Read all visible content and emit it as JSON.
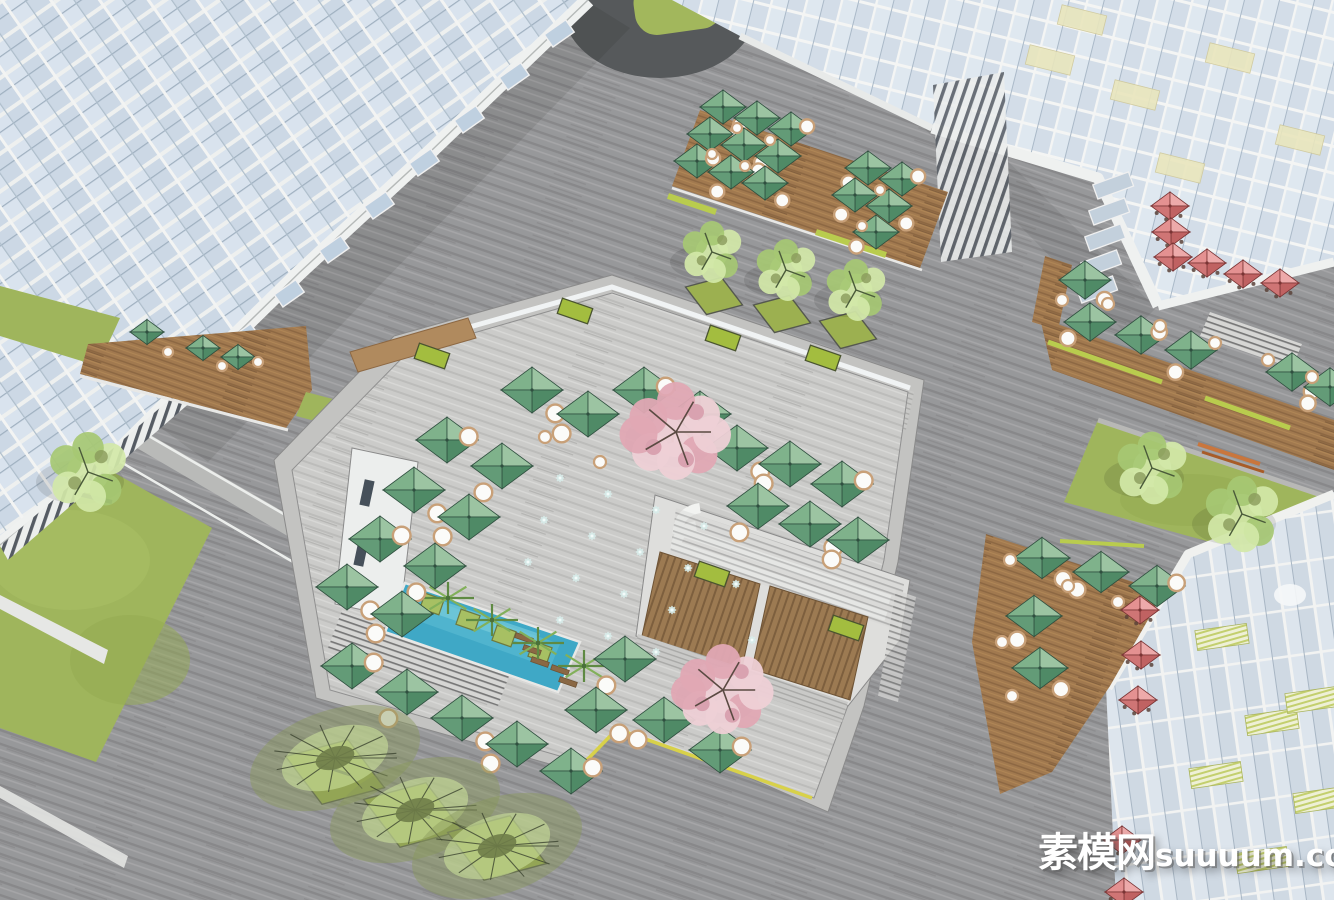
{
  "watermark": {
    "cjk": "素模网",
    "latin": "suuuum.com"
  },
  "colors": {
    "plaza_base": "#97989a",
    "plaza_dark": "#88888a",
    "plaza_light": "#a6a6a8",
    "terrace_base": "#cbcbc9",
    "terrace_dark": "#bdbdbb",
    "terrace_light": "#d8d8d6",
    "umbrella_green_light": "#9cc4a2",
    "umbrella_green_midlight": "#7fb28b",
    "umbrella_green_middark": "#639b77",
    "umbrella_green_dark": "#4f8a66",
    "umbrella_green_edge": "#2f4f3f",
    "umbrella_red_light": "#edaaaa",
    "umbrella_red_midlight": "#e49191",
    "umbrella_red_middark": "#cf7575",
    "umbrella_red_dark": "#c06262",
    "umbrella_red_edge": "#7a3434",
    "table_white": "#fbfbf9",
    "table_ring": "#c8a078",
    "wood_deck": "#a1794f",
    "wood_dark": "#8d6843",
    "grass": "#9fb55c",
    "planter_grass": "#9cb050",
    "lime_box": "#a3bd3f",
    "pool_water": "#3fa8c6",
    "pool_ripple": "#7fd0de",
    "cherry_pink": "#eed0d6",
    "cherry_deep": "#e0a8b4",
    "tree_lime_light": "#d2e8a8",
    "tree_lime_mid": "#a6c873",
    "tree_olive": "#8a9a5b",
    "glass": "#ccd8e5",
    "glass_light": "#dde7f0",
    "mullion": "#f3f4f3",
    "accent_yellow": "#e9e6bd",
    "accent_lime_stripe": "#c3cf6e",
    "bench_orange": "#c9763d",
    "dark_disc": "#56595b",
    "yellow_edge": "#d8d149",
    "watermark_white": "#ffffff"
  },
  "scene": {
    "manhole": [
      455,
      21,
      10
    ],
    "umbrella_groups": [
      {
        "name": "terrace-green",
        "type": "green",
        "s": 31,
        "items": [
          [
            532,
            390
          ],
          [
            588,
            414
          ],
          [
            644,
            390
          ],
          [
            700,
            414
          ],
          [
            737,
            448
          ],
          [
            790,
            464
          ],
          [
            842,
            484
          ],
          [
            758,
            506
          ],
          [
            810,
            524
          ],
          [
            858,
            540
          ],
          [
            447,
            440
          ],
          [
            502,
            466
          ],
          [
            414,
            490
          ],
          [
            469,
            517
          ],
          [
            380,
            539
          ],
          [
            435,
            566
          ],
          [
            347,
            587
          ],
          [
            402,
            614
          ],
          [
            352,
            666
          ],
          [
            407,
            692
          ],
          [
            462,
            718
          ],
          [
            517,
            744
          ],
          [
            571,
            771
          ],
          [
            625,
            659
          ],
          [
            596,
            710
          ],
          [
            664,
            720
          ],
          [
            720,
            750
          ]
        ]
      },
      {
        "name": "top-deck-green",
        "type": "green",
        "s": 23,
        "items": [
          [
            723,
            107
          ],
          [
            757,
            118
          ],
          [
            791,
            129
          ],
          [
            710,
            134
          ],
          [
            744,
            145
          ],
          [
            778,
            156
          ],
          [
            697,
            161
          ],
          [
            731,
            172
          ],
          [
            765,
            183
          ],
          [
            868,
            168
          ],
          [
            902,
            179
          ],
          [
            855,
            195
          ],
          [
            889,
            206
          ],
          [
            876,
            232
          ]
        ]
      },
      {
        "name": "tl-ground-green",
        "type": "green",
        "s": 17,
        "items": [
          [
            147,
            332
          ],
          [
            203,
            348
          ],
          [
            238,
            357
          ]
        ]
      },
      {
        "name": "right-deck-green",
        "type": "green",
        "s": 26,
        "items": [
          [
            1085,
            280
          ],
          [
            1090,
            322
          ],
          [
            1141,
            335
          ],
          [
            1191,
            350
          ],
          [
            1292,
            372
          ],
          [
            1330,
            387
          ]
        ]
      },
      {
        "name": "br-deck-green",
        "type": "green",
        "s": 28,
        "items": [
          [
            1042,
            558
          ],
          [
            1101,
            572
          ],
          [
            1157,
            586
          ],
          [
            1034,
            616
          ],
          [
            1040,
            668
          ]
        ]
      },
      {
        "name": "tr-red",
        "type": "red",
        "s": 19,
        "items": [
          [
            1170,
            206
          ],
          [
            1171,
            232
          ],
          [
            1173,
            257
          ],
          [
            1207,
            263
          ],
          [
            1243,
            274
          ],
          [
            1280,
            283
          ]
        ]
      },
      {
        "name": "br-red",
        "type": "red",
        "s": 19,
        "items": [
          [
            1140,
            610
          ],
          [
            1141,
            655
          ],
          [
            1138,
            700
          ],
          [
            1122,
            840
          ],
          [
            1124,
            892
          ]
        ]
      }
    ],
    "tables": [
      [
        737,
        128,
        5
      ],
      [
        770,
        140,
        5
      ],
      [
        712,
        154,
        5
      ],
      [
        745,
        166,
        5
      ],
      [
        880,
        190,
        5
      ],
      [
        862,
        226,
        5
      ],
      [
        168,
        352,
        5
      ],
      [
        222,
        366,
        5
      ],
      [
        258,
        362,
        5
      ],
      [
        1108,
        304,
        6
      ],
      [
        1160,
        326,
        6
      ],
      [
        1215,
        343,
        6
      ],
      [
        1268,
        360,
        6
      ],
      [
        1312,
        377,
        6
      ],
      [
        1062,
        300,
        6
      ],
      [
        1010,
        560,
        6
      ],
      [
        1068,
        586,
        6
      ],
      [
        1118,
        602,
        6
      ],
      [
        1002,
        642,
        6
      ],
      [
        1012,
        696,
        6
      ],
      [
        545,
        437,
        6
      ],
      [
        600,
        462,
        6
      ]
    ],
    "trees": {
      "cherry": [
        [
          676,
          432,
          50
        ],
        [
          723,
          690,
          46
        ]
      ],
      "lime": [
        [
          712,
          252,
          34
        ],
        [
          786,
          270,
          34
        ],
        [
          856,
          290,
          34
        ],
        [
          1152,
          468,
          40
        ],
        [
          1242,
          514,
          42
        ],
        [
          88,
          472,
          44
        ]
      ],
      "olive": [
        [
          335,
          758
        ],
        [
          415,
          810
        ],
        [
          497,
          846
        ]
      ]
    },
    "tree_planters": [
      [
        714,
        296,
        30
      ],
      [
        782,
        314,
        30
      ],
      [
        848,
        330,
        30
      ],
      [
        335,
        772,
        52
      ],
      [
        413,
        815,
        52
      ],
      [
        497,
        848,
        52
      ]
    ],
    "planter_boxes": [
      [
        432,
        356
      ],
      [
        575,
        311
      ],
      [
        723,
        338
      ],
      [
        823,
        358
      ],
      [
        712,
        574
      ],
      [
        846,
        628
      ]
    ],
    "jets": [
      [
        560,
        478
      ],
      [
        608,
        494
      ],
      [
        656,
        510
      ],
      [
        704,
        526
      ],
      [
        544,
        520
      ],
      [
        592,
        536
      ],
      [
        640,
        552
      ],
      [
        688,
        568
      ],
      [
        736,
        584
      ],
      [
        528,
        562
      ],
      [
        576,
        578
      ],
      [
        624,
        594
      ],
      [
        672,
        610
      ],
      [
        560,
        620
      ],
      [
        608,
        636
      ],
      [
        656,
        652
      ],
      [
        704,
        668
      ],
      [
        752,
        640
      ]
    ],
    "palms": [
      [
        448,
        598
      ],
      [
        492,
        620
      ],
      [
        538,
        643
      ],
      [
        584,
        666
      ]
    ],
    "pool_planters": [
      [
        432,
        604
      ],
      [
        468,
        620
      ],
      [
        504,
        636
      ],
      [
        540,
        652
      ]
    ],
    "loungers": [
      [
        524,
        638
      ],
      [
        532,
        650
      ],
      [
        540,
        662
      ],
      [
        560,
        670
      ],
      [
        568,
        682
      ]
    ],
    "benches": [
      {
        "x1": 1198,
        "y1": 444,
        "x2": 1260,
        "y2": 464,
        "c": "#c9763d",
        "w": 4
      },
      {
        "x1": 1202,
        "y1": 452,
        "x2": 1264,
        "y2": 472,
        "c": "#a85c28",
        "w": 3
      },
      {
        "x1": 78,
        "y1": 494,
        "x2": 112,
        "y2": 502,
        "c": "#3a3f3a",
        "w": 4
      },
      {
        "x1": 320,
        "y1": 765,
        "x2": 350,
        "y2": 775,
        "c": "#2f332f",
        "w": 3
      },
      {
        "x1": 400,
        "y1": 808,
        "x2": 430,
        "y2": 818,
        "c": "#2f332f",
        "w": 3
      },
      {
        "x1": 482,
        "y1": 840,
        "x2": 512,
        "y2": 850,
        "c": "#2f332f",
        "w": 3
      }
    ],
    "yellow_panels": [
      [
        1222,
        637
      ],
      [
        1272,
        722
      ],
      [
        1216,
        775
      ],
      [
        1312,
        700
      ],
      [
        1262,
        860
      ],
      [
        1320,
        800
      ]
    ],
    "tr_yellow_panels": [
      [
        1050,
        60
      ],
      [
        1135,
        95
      ],
      [
        1230,
        58
      ],
      [
        1300,
        140
      ],
      [
        1180,
        168
      ],
      [
        1082,
        20
      ]
    ]
  }
}
